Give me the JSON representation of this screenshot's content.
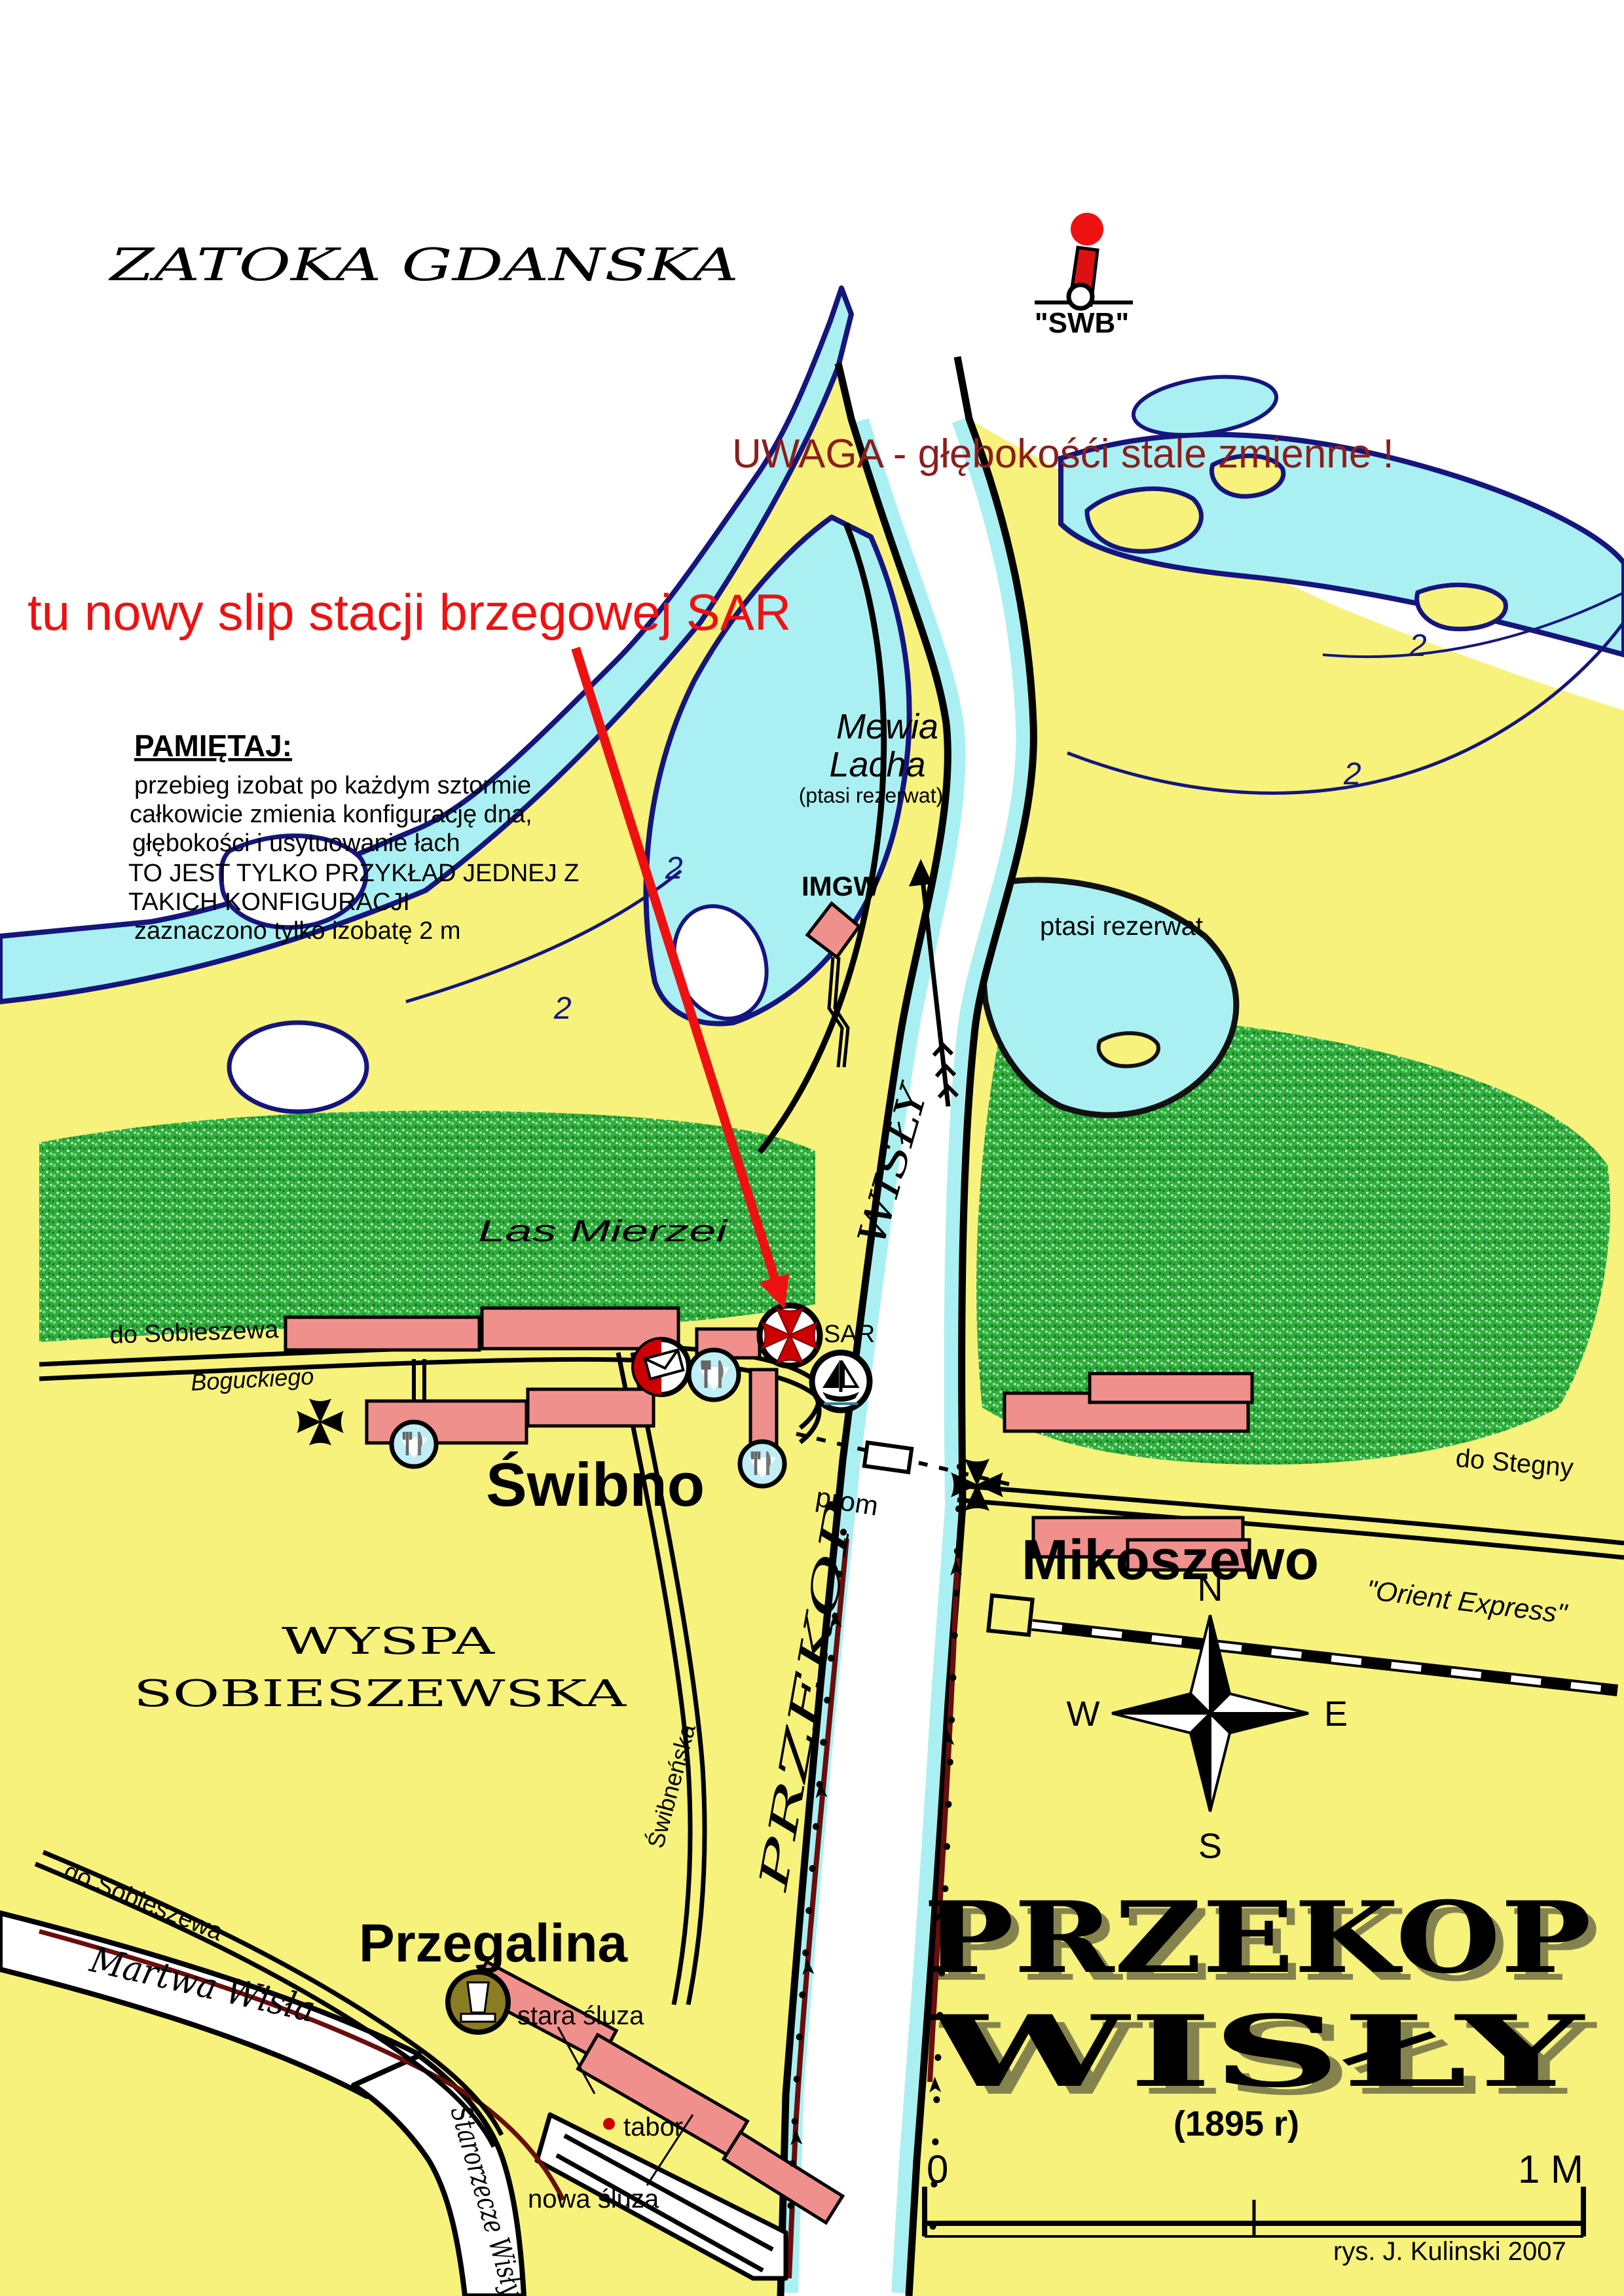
{
  "map": {
    "sea_title": "ZATOKA GDANSKA",
    "logo": {
      "label": "\"SWB\""
    },
    "warning": "UWAGA - głębokośći stale zmienne !",
    "annotation": "tu nowy slip stacji brzegowej SAR",
    "reminder": {
      "title": "PAMIĘTAJ:",
      "lines": [
        "przebieg izobat po każdym sztormie",
        "całkowicie zmienia konfigurację dna,",
        "głębokości i usytuowanie łach",
        "TO JEST TYLKO PRZYKŁAD JEDNEJ Z",
        "TAKICH KONFIGURACJI",
        "zaznaczono tylko izobatę 2 m"
      ]
    },
    "nature": {
      "mewia_line1": "Mewia",
      "mewia_line2": "Lacha",
      "mewia_sub": "(ptasi rezerwat)",
      "bird_reserve": "ptasi rezerwat",
      "forest": "Las Mierzei"
    },
    "places": {
      "swibno": "Świbno",
      "mikoszewo": "Mikoszewo",
      "przegalina": "Przegalina",
      "wyspa_line1": "WYSPA",
      "wyspa_line2": "SOBIESZEWSKA"
    },
    "stations": {
      "imgw": "IMGW",
      "sar": "SAR"
    },
    "roads": {
      "to_sobieszewo_north": "do Sobieszewa",
      "boguckiego": "Boguckiego",
      "to_stegny": "do Stegny",
      "swibnenska": "Świbneńska",
      "to_sobieszewo_south": "do Sobieszewa",
      "ferry": "prom",
      "railway": "\"Orient Express\""
    },
    "waterways": {
      "river_upper": "WISŁY",
      "river_lower": "PRZEKOP",
      "martwa_wisla": "Martwa Wisła",
      "starorzecze": "Starorzecze Wisły"
    },
    "locks": {
      "old": "stara śluza",
      "new": "nowa śluza",
      "depot": "tabor"
    },
    "compass": {
      "n": "N",
      "s": "S",
      "e": "E",
      "w": "W"
    },
    "title_block": {
      "line1": "PRZEKOP",
      "line2": "WISŁY",
      "year": "(1895 r)"
    },
    "scale_bar": {
      "start": "0",
      "end": "1 M"
    },
    "isobath_label": "2",
    "credit": "rys. J. Kulinski 2007",
    "colors": {
      "land": "#f6f27b",
      "water": "#aaf0f2",
      "sea_outline": "#15157e",
      "forest": "#2fae3c",
      "buildings": "#f0908d",
      "warning_red": "#8b1e1e",
      "annotation_red": "#ee1111",
      "dike_red": "#6b0d0d",
      "lock_badge": "#8b7d22"
    }
  }
}
